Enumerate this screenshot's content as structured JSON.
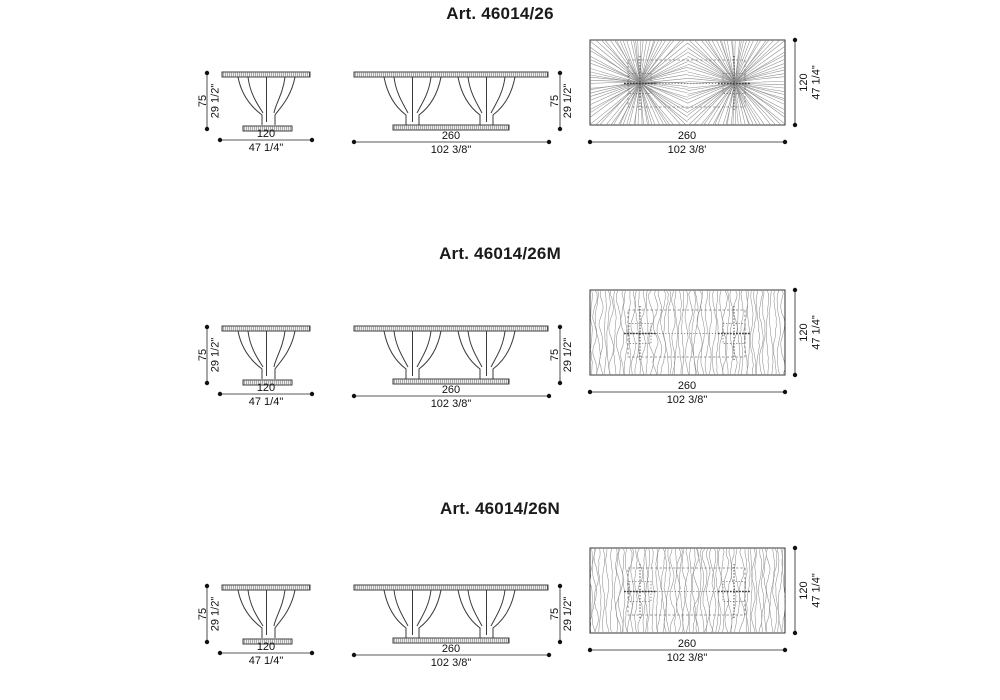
{
  "colors": {
    "background": "#ffffff",
    "line": "#333333",
    "texture": "#8f8f8f",
    "text": "#111111"
  },
  "sections": [
    {
      "title": "Art. 46014/26",
      "texture": "radial",
      "side": {
        "h_cm": "75",
        "h_in": "29 1/2\"",
        "w_cm": "120",
        "w_in": "47 1/4\""
      },
      "front": {
        "w_cm": "260",
        "w_in": "102 3/8\"",
        "h_cm": "75",
        "h_in": "29 1/2\""
      },
      "top": {
        "w_cm": "260",
        "w_in": "102 3/8'",
        "d_cm": "120",
        "d_in": "47 1/4\""
      }
    },
    {
      "title": "Art. 46014/26M",
      "texture": "grain",
      "side": {
        "h_cm": "75",
        "h_in": "29 1/2\"",
        "w_cm": "120",
        "w_in": "47 1/4\""
      },
      "front": {
        "w_cm": "260",
        "w_in": "102 3/8\"",
        "h_cm": "75",
        "h_in": "29 1/2\""
      },
      "top": {
        "w_cm": "260",
        "w_in": "102 3/8\"",
        "d_cm": "120",
        "d_in": "47 1/4\""
      }
    },
    {
      "title": "Art. 46014/26N",
      "texture": "grain",
      "side": {
        "h_cm": "75",
        "h_in": "29 1/2\"",
        "w_cm": "120",
        "w_in": "47 1/4\""
      },
      "front": {
        "w_cm": "260",
        "w_in": "102 3/8\"",
        "h_cm": "75",
        "h_in": "29 1/2\""
      },
      "top": {
        "w_cm": "260",
        "w_in": "102 3/8\"",
        "d_cm": "120",
        "d_in": "47 1/4\""
      }
    }
  ]
}
